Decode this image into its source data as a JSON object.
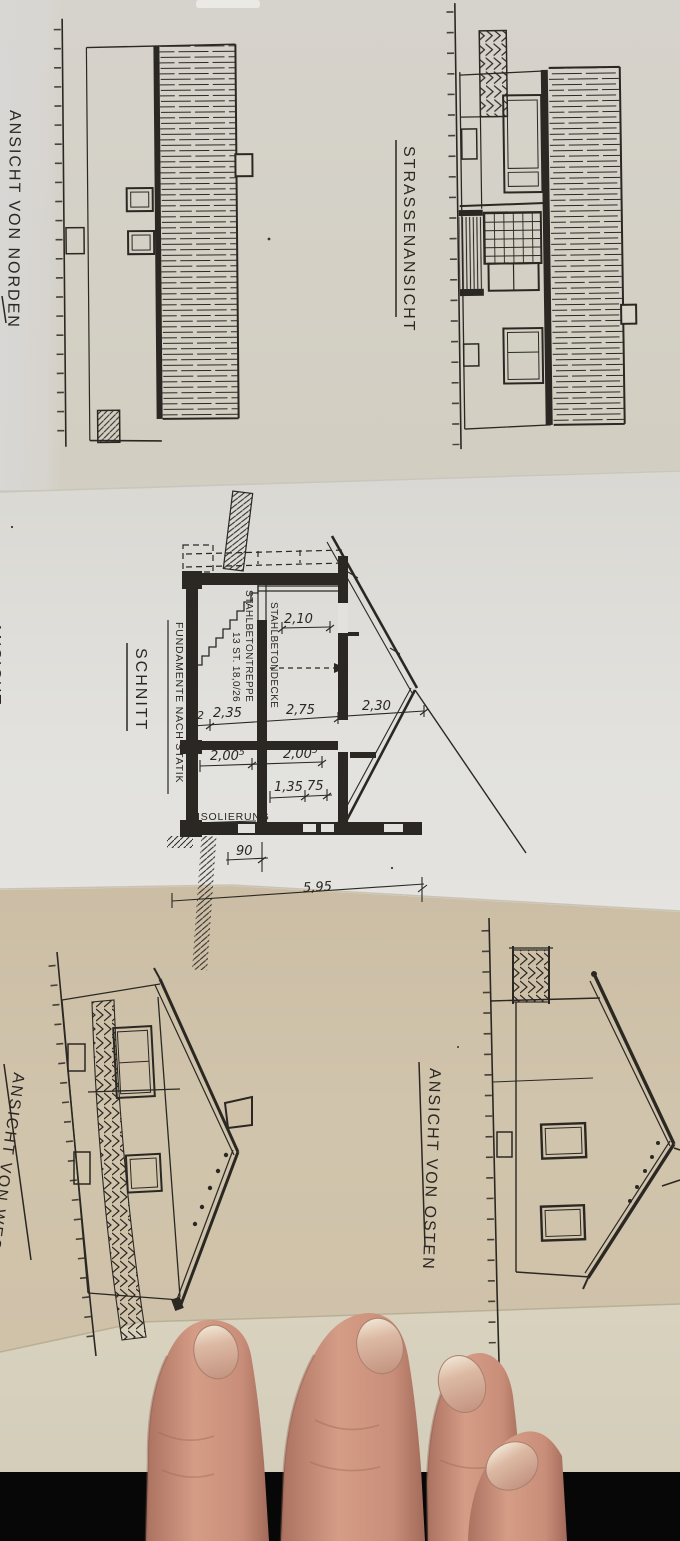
{
  "labels": {
    "north": "ANSICHT VON NORDEN",
    "street": "STRASSENANSICHT",
    "schnitt": "SCHNITT",
    "west": "ANSICHT VON WESTEN",
    "east": "ANSICHT VON OSTEN",
    "edge_partial": "ANSICHT"
  },
  "section": {
    "stair_note_1": "STAHLBETONTREPPE",
    "stair_note_2": "13 ST. 18,0/26",
    "ceiling_note": "STAHLBETONDECKE",
    "foundation_note": "FUNDAMENTE NACH STATIK",
    "insulation_note": "ISOLIERUNG",
    "dims": {
      "w1": "12",
      "w2": "2,35",
      "w3": "2,75",
      "w4": "2,30",
      "h1": "2,00",
      "h1s": "5",
      "h2": "2,00",
      "h2s": "5",
      "h3": "1,35",
      "h4": "75",
      "room": "2,10",
      "found": "90",
      "total": "5,95"
    }
  },
  "colors": {
    "ink": "#2b2823",
    "paper_top": "#d4d1c9",
    "paper_mid": "#e2e1dd",
    "paper_tan": "#cfc2a9",
    "paper_cream": "#d6d0bd",
    "background_black": "#070707",
    "skin": "#cf9480"
  }
}
